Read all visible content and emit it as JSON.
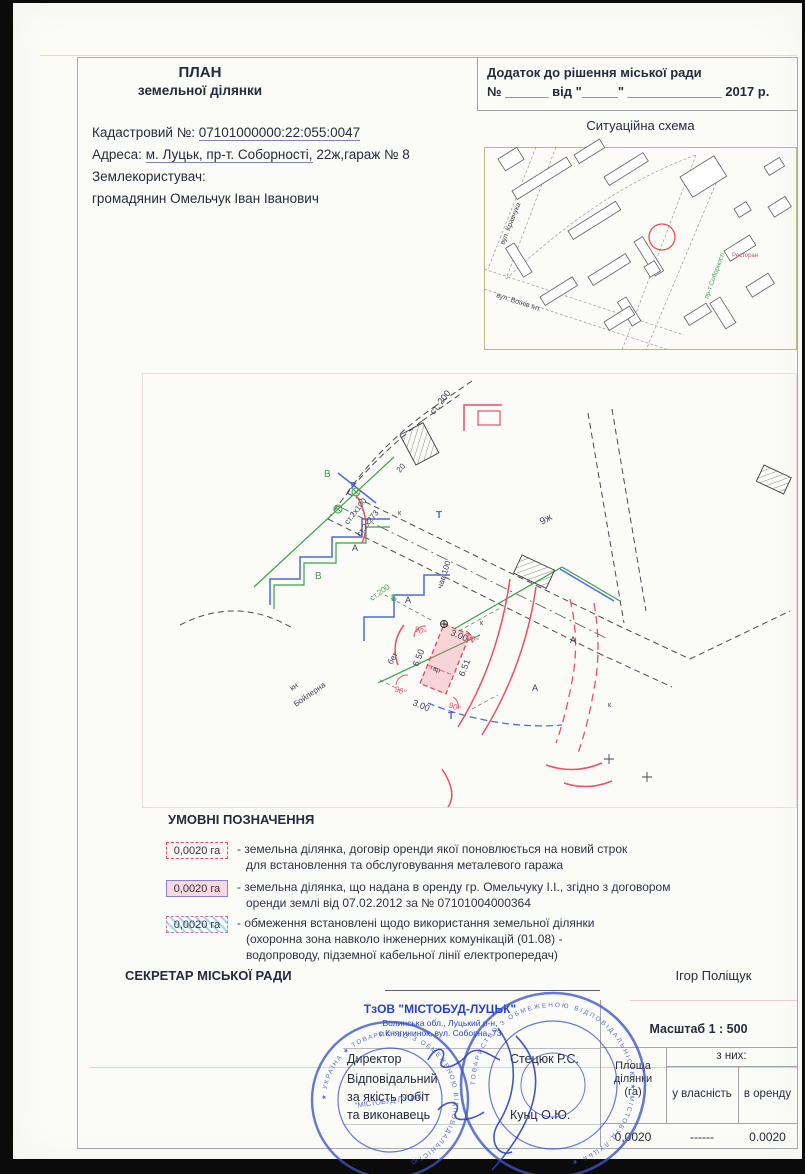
{
  "header": {
    "title1": "ПЛАН",
    "title2": "земельної ділянки",
    "cad_label": "Кадастровий №:",
    "cad_value": "07101000000:22:055:0047",
    "addr_label": "Адреса:",
    "addr_value_u": "м. Луцьк, пр-т. Соборності,",
    "addr_value_rest": "22ж,гараж № 8",
    "user_label": "Землекористувач:",
    "user_value": "громадянин Омельчук Іван Іванович"
  },
  "annex": {
    "line1": "Додаток до рішення міської ради",
    "line2": "№ ______ від \"_____\" _____________ 2017 р."
  },
  "map": {
    "title": "Ситуаційна схема",
    "street1": "вул. Кравчука",
    "street2": "вул. Воїнів Інт.",
    "street3": "пр-т Соборності",
    "restaurant": "Ресторан"
  },
  "plan": {
    "st200_top": "ст. 200",
    "st2x100": "ст.2х100",
    "st2x273": "ст.2х273",
    "st200_g": "ст.200",
    "chav100": "чав.100",
    "n20": "20",
    "l9zh": "9ж",
    "kn": "кн",
    "boiler": "Бойлерна",
    "bet": "бет",
    "gar": "гар",
    "d650": "6.50",
    "d651": "6.51",
    "d300t": "3.00",
    "d300b": "3.00",
    "deg": "90°",
    "A": "А",
    "B": "Б",
    "V": "В",
    "T": "Т",
    "kx": "к"
  },
  "legend": {
    "title": "УМОВНІ ПОЗНАЧЕННЯ",
    "items": [
      {
        "area": "0,0020 га",
        "line1": "- земельна ділянка, договір оренди якої поновлюється на новий строк",
        "line2": "для встановлення та обслуговування металевого гаража"
      },
      {
        "area": "0,0020 га",
        "line1": "- земельна ділянка, що надана в оренду гр. Омельчуку І.І., згідно з договором",
        "line2": "оренди землі від 07.02.2012 за № 07101004000364"
      },
      {
        "area": "0,0020 га",
        "line1": "- обмеження встановлені щодо використання земельної ділянки",
        "line2": "(охоронна зона навколо інженерних комунікацій (01.08) -",
        "line3": "водопроводу, підземної кабельної лінії електропередач)"
      }
    ]
  },
  "officials": {
    "secretary_label": "СЕКРЕТАР МІСЬКОЇ РАДИ",
    "secretary_name": "Ігор Поліщук"
  },
  "firm": {
    "name": "ТзОВ \"МІСТОБУД-ЛУЦЬК\"",
    "addr1": "Волинська обл., Луцький р-н,",
    "addr2": "с.Княгининок, вул. Соборна, 73",
    "director_label": "Директор",
    "director_name": "Стецюк Р.С.",
    "resp1": "Відповідальний",
    "resp2": "за якість робіт",
    "resp3": "та виконавець",
    "executor_name": "Кунц О.Ю."
  },
  "scale_label": "Масштаб 1 : 500",
  "area_table": {
    "col_area_l1": "Площа",
    "col_area_l2": "ділянки",
    "col_area_l3": "(га)",
    "span": "з них:",
    "col_own": "у власність",
    "col_rent": "в оренду",
    "val_area": "0,0020",
    "val_own": "------",
    "val_rent": "0.0020"
  },
  "stamps": {
    "ring1": "★ УКРАЇНА ★ ТОВАРИСТВО З ОБМЕЖЕНОЮ ВІДПОВІДАЛЬНІСТЮ",
    "center1": "\"МІСТОБУД-ЛУЦЬК\"",
    "ring2": "ТОВАРИСТВО З ОБМЕЖЕНОЮ ВІДПОВІДАЛЬНІСТЮ ★ МІСТОБУД-ЛУЦЬК ★"
  }
}
